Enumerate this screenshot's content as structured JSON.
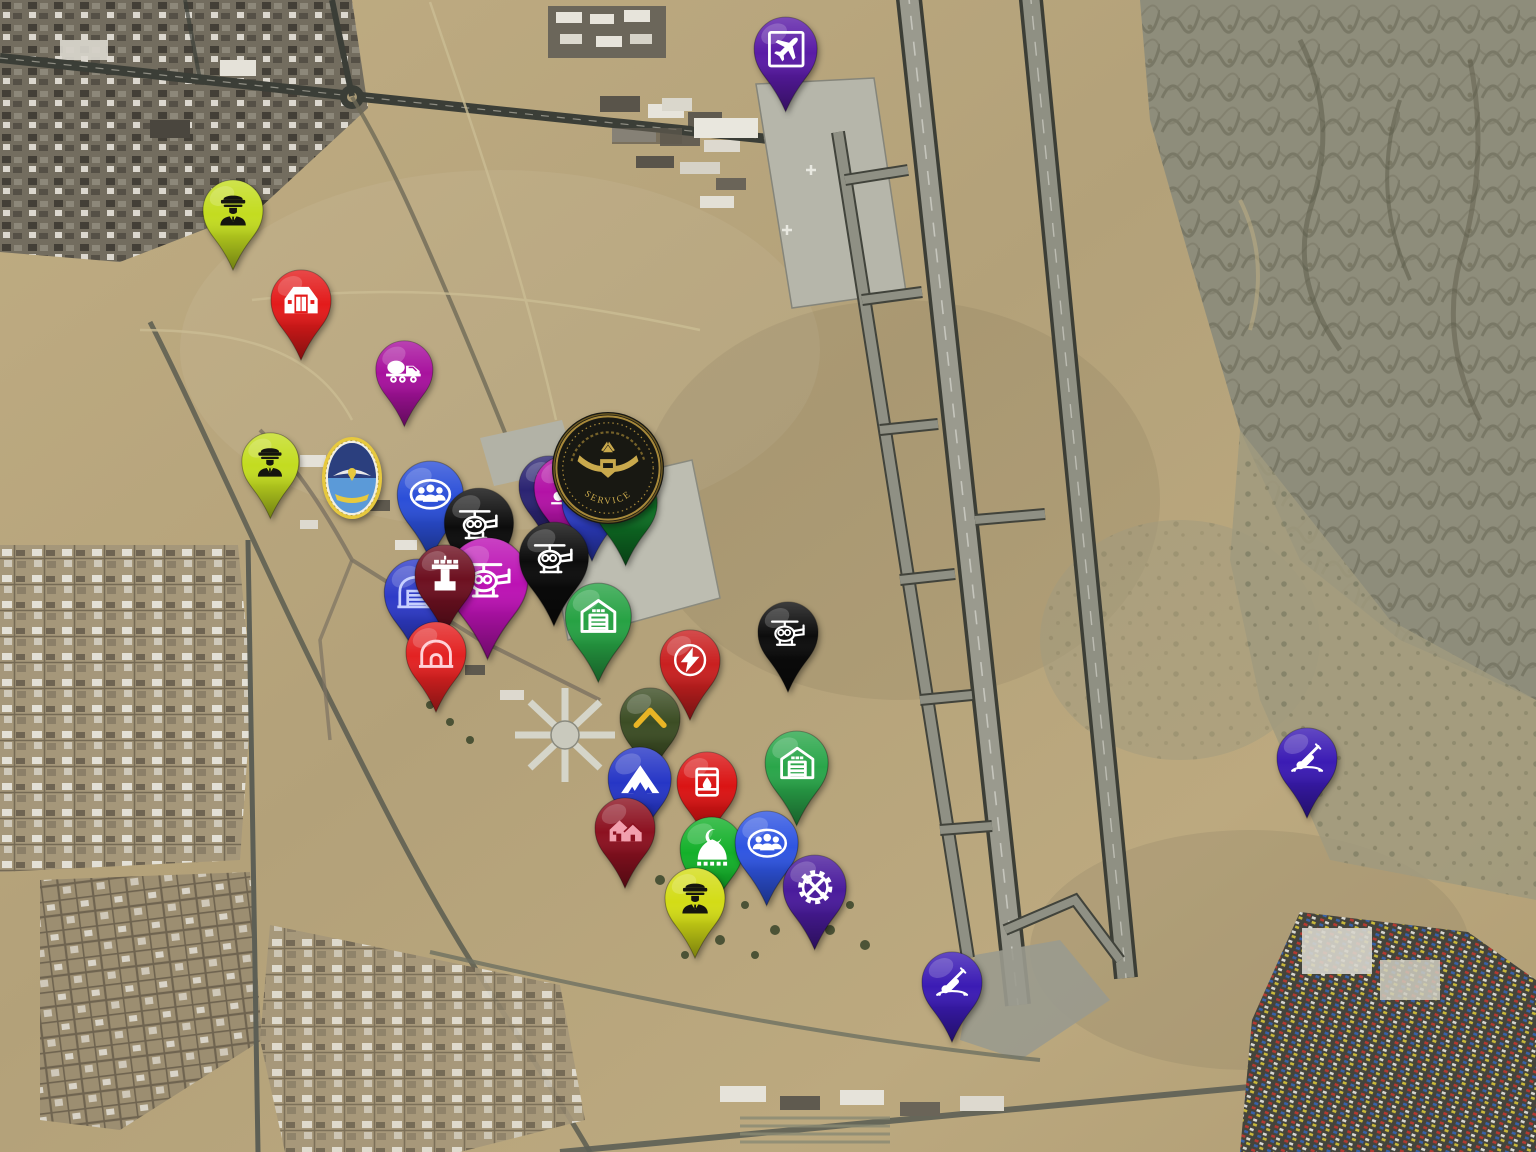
{
  "map": {
    "palette": {
      "desert": "#b8a67e",
      "runway": "#9a9a8e",
      "road": "#3b3e37",
      "apron": "#bdbdb1"
    }
  },
  "emblems": {
    "airforce_crest": {
      "x": 352,
      "y": 478,
      "gold": "#e7c93e",
      "blue": "#5b9ad8"
    },
    "service_coin": {
      "x": 608,
      "y": 468,
      "caption": "SERVICE",
      "bg": "#181812",
      "gold": "#c9a94c"
    }
  },
  "markers": [
    {
      "id": "airport",
      "icon": "airplane",
      "color": "#5a1ba6",
      "icon_color": "#ffffff",
      "x": 786,
      "y": 114,
      "s": 1.05
    },
    {
      "id": "officer-nw",
      "icon": "officer",
      "color": "#c3dc20",
      "icon_color": "#15150f",
      "x": 233,
      "y": 272,
      "s": 1.0
    },
    {
      "id": "hangar-nw",
      "icon": "hangar",
      "color": "#e31b1b",
      "icon_color": "#ffffff",
      "x": 301,
      "y": 362,
      "s": 1.0
    },
    {
      "id": "mixer-truck",
      "icon": "mixer-truck",
      "color": "#a8129e",
      "icon_color": "#ffffff",
      "x": 404,
      "y": 428,
      "s": 0.95
    },
    {
      "id": "officer-w",
      "icon": "officer",
      "color": "#c3dc20",
      "icon_color": "#15150f",
      "x": 270,
      "y": 520,
      "s": 0.95
    },
    {
      "id": "facility-navy",
      "icon": "building",
      "color": "#2b2472",
      "icon_color": "#ffffff",
      "x": 549,
      "y": 548,
      "s": 1.0
    },
    {
      "id": "searchlight",
      "icon": "searchlight",
      "color": "#b312a6",
      "icon_color": "#ffffff",
      "x": 566,
      "y": 553,
      "s": 1.05
    },
    {
      "id": "facility-blue",
      "icon": "building",
      "color": "#2d3dc4",
      "icon_color": "#ffffff",
      "x": 592,
      "y": 563,
      "s": 1.0
    },
    {
      "id": "helicopter-green",
      "icon": "helicopter-solid",
      "color": "#0e6e24",
      "icon_color": "#ffffff",
      "x": 626,
      "y": 568,
      "s": 1.05
    },
    {
      "id": "personnel-n",
      "icon": "people-group",
      "color": "#2b4fd8",
      "icon_color": "#ffffff",
      "x": 430,
      "y": 562,
      "s": 1.1
    },
    {
      "id": "helicopter-1",
      "icon": "helicopter",
      "color": "#0c0c0c",
      "icon_color": "#ffffff",
      "x": 479,
      "y": 594,
      "s": 1.15
    },
    {
      "id": "warehouse-w",
      "icon": "hangar2",
      "color": "#2e3bc8",
      "icon_color": "#c7d0ff",
      "x": 417,
      "y": 660,
      "s": 1.1
    },
    {
      "id": "helicopter-2",
      "icon": "helicopter",
      "color": "#bc12b4",
      "icon_color": "#ffffff",
      "x": 488,
      "y": 662,
      "s": 1.35
    },
    {
      "id": "control-tower",
      "icon": "control-tower",
      "color": "#6d1020",
      "icon_color": "#ffffff",
      "x": 445,
      "y": 637,
      "s": 1.0
    },
    {
      "id": "arch-shelter",
      "icon": "arch",
      "color": "#e32222",
      "icon_color": "#ffd2d8",
      "x": 436,
      "y": 714,
      "s": 1.0
    },
    {
      "id": "helicopter-3",
      "icon": "helicopter",
      "color": "#0c0c0c",
      "icon_color": "#ffffff",
      "x": 554,
      "y": 628,
      "s": 1.15
    },
    {
      "id": "warehouse-c",
      "icon": "warehouse",
      "color": "#27a244",
      "icon_color": "#ffffff",
      "x": 598,
      "y": 684,
      "s": 1.1
    },
    {
      "id": "helicopter-4",
      "icon": "helicopter",
      "color": "#0c0c0c",
      "icon_color": "#ffffff",
      "x": 788,
      "y": 694,
      "s": 1.0
    },
    {
      "id": "power",
      "icon": "lightning",
      "color": "#c92020",
      "icon_color": "#ffffff",
      "x": 690,
      "y": 722,
      "s": 1.0
    },
    {
      "id": "rank-post",
      "icon": "chevron",
      "color": "#3c4d24",
      "icon_color": "#e9b525",
      "x": 650,
      "y": 780,
      "s": 1.0
    },
    {
      "id": "warehouse-e",
      "icon": "warehouse",
      "color": "#2aa64a",
      "icon_color": "#ffffff",
      "x": 797,
      "y": 828,
      "s": 1.05
    },
    {
      "id": "tents",
      "icon": "tent",
      "color": "#2636c6",
      "icon_color": "#ffffff",
      "x": 640,
      "y": 844,
      "s": 1.05
    },
    {
      "id": "fuel",
      "icon": "fuel-barrel",
      "color": "#da1414",
      "icon_color": "#ffffff",
      "x": 707,
      "y": 844,
      "s": 1.0
    },
    {
      "id": "housing",
      "icon": "houses",
      "color": "#8c1120",
      "icon_color": "#f2a0ae",
      "x": 625,
      "y": 890,
      "s": 1.0
    },
    {
      "id": "mosque",
      "icon": "mosque",
      "color": "#14b02a",
      "icon_color": "#ffffff",
      "x": 712,
      "y": 914,
      "s": 1.05
    },
    {
      "id": "personnel-s",
      "icon": "people-group",
      "color": "#2f55e2",
      "icon_color": "#ffffff",
      "x": 767,
      "y": 908,
      "s": 1.05
    },
    {
      "id": "officer-s",
      "icon": "officer",
      "color": "#d3dc16",
      "icon_color": "#15150f",
      "x": 695,
      "y": 960,
      "s": 1.0
    },
    {
      "id": "maintenance",
      "icon": "gear-tools",
      "color": "#4a1b9c",
      "icon_color": "#ffffff",
      "x": 815,
      "y": 952,
      "s": 1.05
    },
    {
      "id": "aa-gun-s",
      "icon": "aa-gun",
      "color": "#3b1bb4",
      "icon_color": "#ffffff",
      "x": 952,
      "y": 1044,
      "s": 1.0
    },
    {
      "id": "aa-gun-e",
      "icon": "aa-gun",
      "color": "#3b1bb4",
      "icon_color": "#ffffff",
      "x": 1307,
      "y": 820,
      "s": 1.0
    }
  ]
}
